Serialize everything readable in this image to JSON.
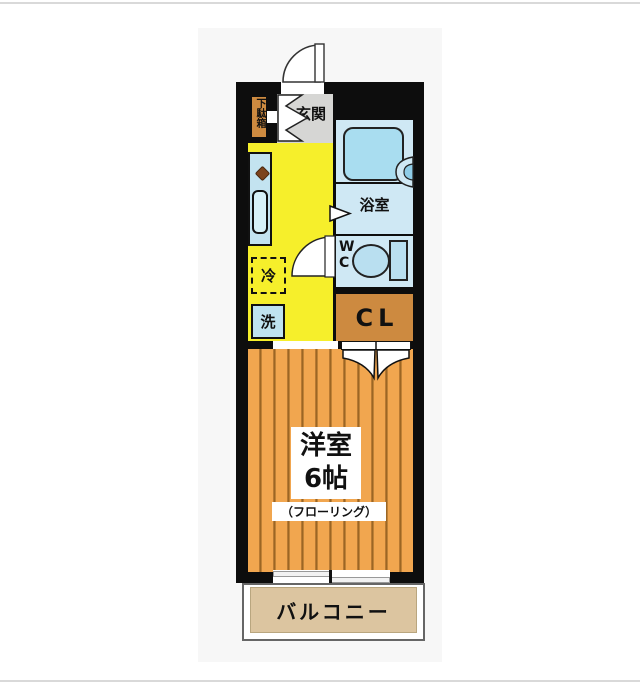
{
  "page": {
    "type": "apartment-floor-plan",
    "background_color": "#ffffff",
    "rule_color": "#d9d9d9"
  },
  "floorplan": {
    "wall_color": "#0d0d0d",
    "rooms": {
      "genkan": {
        "label": "玄関",
        "floor_color": "#d6d6d4"
      },
      "getabako": {
        "label": "下駄箱",
        "color": "#cd8a40"
      },
      "bathroom": {
        "label": "浴室",
        "floor_color": "#cfe8f4",
        "tub_color": "#a9ddf0"
      },
      "wc": {
        "line1": "W",
        "line2": "C",
        "floor_color": "#cfe8f4"
      },
      "closet": {
        "label": "CL",
        "color": "#cd8a40"
      },
      "kitchen": {
        "refrigerator_label": "冷",
        "washer_label": "洗",
        "floor_color": "#f6ef2b"
      },
      "western_room": {
        "name": "洋室",
        "size": "6帖",
        "floor_note": "（フローリング）",
        "floor_color": "#f1a64f"
      },
      "balcony": {
        "label": "バルコニー",
        "floor_color": "#dcc5a0"
      }
    },
    "fixtures": [
      "entrance-door-arc",
      "genkan-double-door",
      "shoe-cabinet",
      "kitchen-counter",
      "sink",
      "stove-burner",
      "bathtub",
      "washbasin",
      "bathroom-door-marker",
      "toilet",
      "wc-door-arc",
      "refrigerator-space",
      "washing-machine-space",
      "closet-folding-doors",
      "sliding-window",
      "balcony"
    ]
  }
}
